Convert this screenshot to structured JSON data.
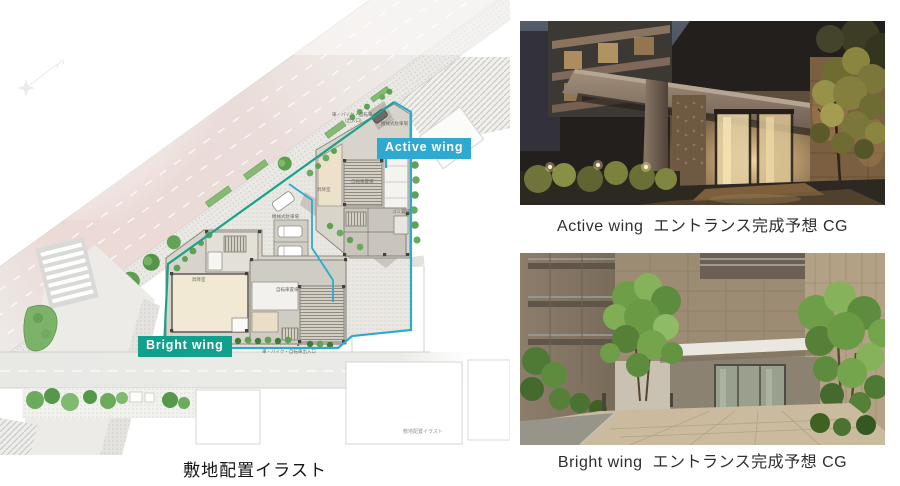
{
  "site_plan": {
    "caption": "敷地配置イラスト",
    "watermark": "敷地配置イラスト",
    "active_wing_label": "Active wing",
    "bright_wing_label": "Bright wing",
    "north_mark": "N",
    "colors": {
      "active_wing_badge": "#2da9d2",
      "bright_wing_badge": "#10a08b",
      "boundary_cyan": "#2caacf",
      "boundary_green": "#1ba28b",
      "road_pink": "#ecd9d5",
      "tree_green": "#6cab5c"
    },
    "tiny_labels": [
      {
        "text": "車・バイク・自転車",
        "x": 332,
        "y": 113,
        "rot": 0
      },
      {
        "text": "(出入口)",
        "x": 345,
        "y": 119,
        "rot": 0
      },
      {
        "text": "機械式駐車場",
        "x": 381,
        "y": 122,
        "rot": 0
      },
      {
        "text": "自転車置場",
        "x": 351,
        "y": 180,
        "rot": 0
      },
      {
        "text": "昇降室",
        "x": 317,
        "y": 188,
        "rot": 0
      },
      {
        "text": "ゴミ置場",
        "x": 392,
        "y": 210,
        "rot": 0
      },
      {
        "text": "機械式駐車場",
        "x": 272,
        "y": 215,
        "rot": 0
      },
      {
        "text": "昇降室",
        "x": 192,
        "y": 278,
        "rot": 0
      },
      {
        "text": "自転車置場",
        "x": 276,
        "y": 288,
        "rot": 0
      },
      {
        "text": "▲",
        "x": 296,
        "y": 343,
        "rot": 0
      },
      {
        "text": "車・バイク・自転車出入口",
        "x": 262,
        "y": 350,
        "rot": 0
      }
    ]
  },
  "photos": {
    "active": {
      "caption": "Active wing  エントランス完成予想 CG"
    },
    "bright": {
      "caption": "Bright wing  エントランス完成予想 CG"
    }
  }
}
